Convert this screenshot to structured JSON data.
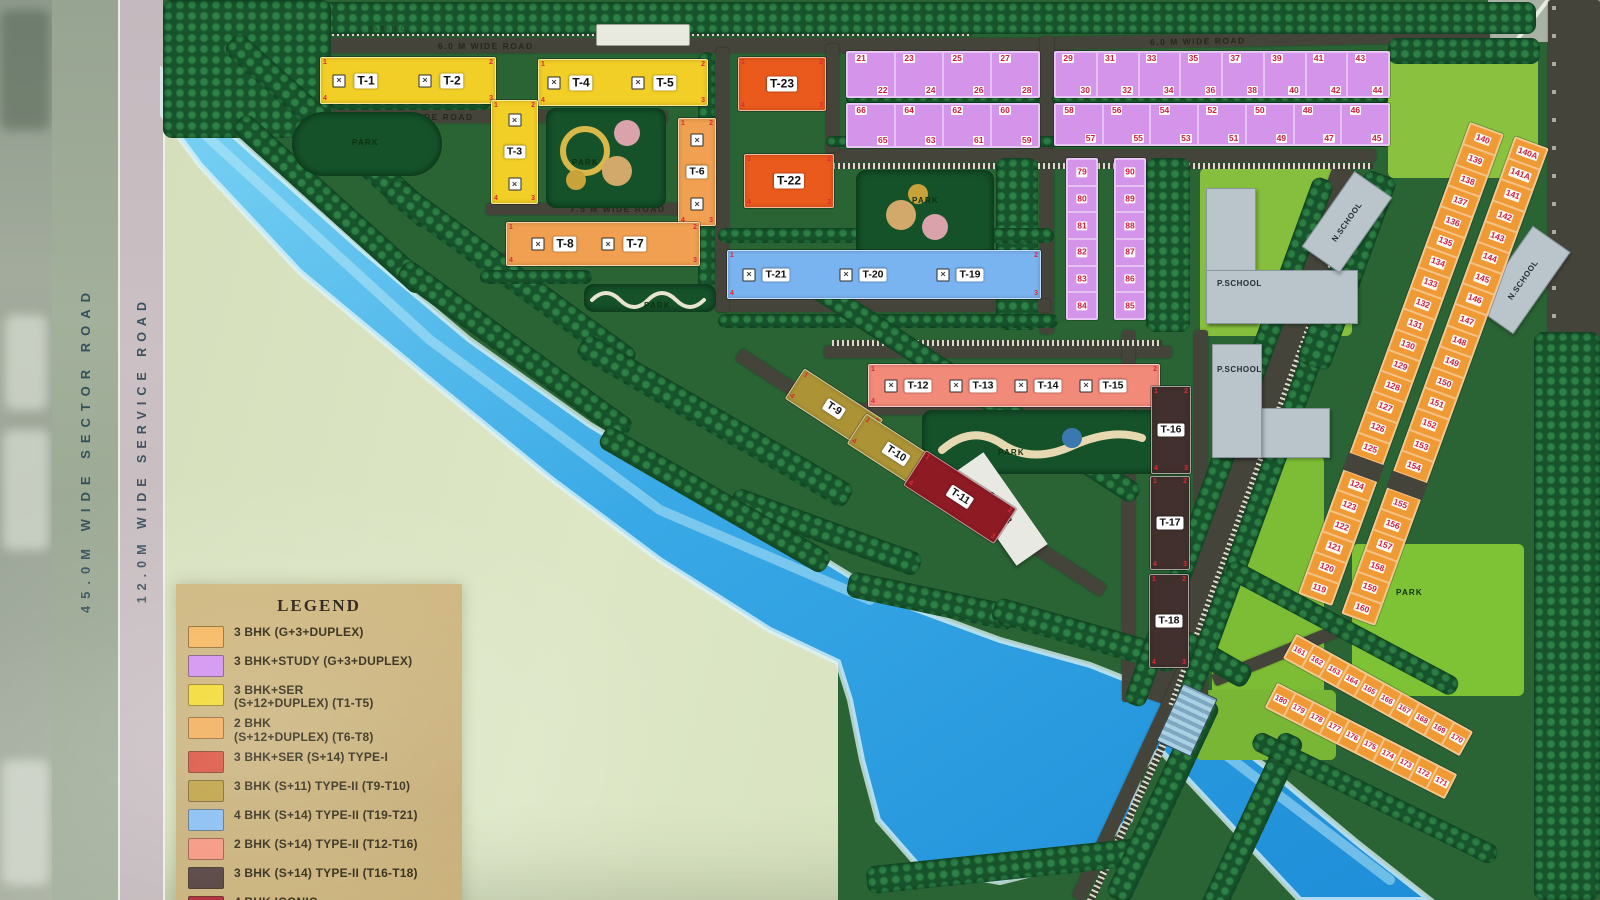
{
  "side_roads": {
    "sector": "45.0M WIDE SECTOR ROAD",
    "service": "12.0M WIDE SERVICE ROAD"
  },
  "roads": {
    "road-top": "6.0 M WIDE ROAD",
    "road-topright": "6.0 M WIDE ROAD",
    "road-75a": "7.5 M WIDE ROAD",
    "road-75b": "7.5 M WIDE ROAD",
    "road-75c": "7.5 M WIDE ROAD"
  },
  "facilities": {
    "parking": "PARKING",
    "park": "PARK",
    "p_school": "P.SCHOOL",
    "n_school": "N.SCHOOL",
    "club": "CLUB"
  },
  "towers": {
    "t1": "T-1",
    "t2": "T-2",
    "t3": "T-3",
    "t4": "T-4",
    "t5": "T-5",
    "t6": "T-6",
    "t7": "T-7",
    "t8": "T-8",
    "t9": "T-9",
    "t10": "T-10",
    "t11": "T-11",
    "t12": "T-12",
    "t13": "T-13",
    "t14": "T-14",
    "t15": "T-15",
    "t16": "T-16",
    "t17": "T-17",
    "t18": "T-18",
    "t19": "T-19",
    "t20": "T-20",
    "t21": "T-21",
    "t22": "T-22",
    "t23": "T-23"
  },
  "corner_digits": [
    "1",
    "2",
    "3",
    "4"
  ],
  "icons": {
    "unit_marker": "✕"
  },
  "plot_blocks": {
    "pa1": {
      "upper": [
        "21",
        "23",
        "25",
        "27"
      ],
      "lower": [
        "22",
        "24",
        "26",
        "28"
      ]
    },
    "pa2": {
      "upper": [
        "66",
        "64",
        "62",
        "60"
      ],
      "lower": [
        "65",
        "63",
        "61",
        "59"
      ]
    },
    "pb1": {
      "upper": [
        "29",
        "31",
        "33",
        "35",
        "37",
        "39",
        "41",
        "43"
      ],
      "lower": [
        "30",
        "32",
        "34",
        "36",
        "38",
        "40",
        "42",
        "44"
      ]
    },
    "pb2": {
      "upper": [
        "58",
        "56",
        "54",
        "52",
        "50",
        "48",
        "46"
      ],
      "lower": [
        "57",
        "55",
        "53",
        "51",
        "49",
        "47",
        "45"
      ]
    },
    "pv1": {
      "numbers": [
        "79",
        "80",
        "81",
        "82",
        "83",
        "84"
      ]
    },
    "pv2": {
      "numbers": [
        "90",
        "89",
        "88",
        "87",
        "86",
        "85"
      ]
    },
    "os_inner": {
      "numbers": [
        "140",
        "139",
        "138",
        "137",
        "136",
        "135",
        "134",
        "133",
        "132",
        "131",
        "130",
        "129",
        "128",
        "127",
        "126",
        "125"
      ],
      "numbers2": [
        "124",
        "123",
        "122",
        "121",
        "120",
        "119"
      ]
    },
    "os_outer": {
      "numbers": [
        "140A",
        "141A",
        "141",
        "142",
        "143",
        "144",
        "145",
        "146",
        "147",
        "148",
        "149",
        "150",
        "151",
        "152",
        "153",
        "154"
      ],
      "numbers2": [
        "155",
        "156",
        "157",
        "158",
        "159",
        "160"
      ]
    },
    "ob_row1": {
      "numbers": [
        "161",
        "162",
        "163",
        "164",
        "165",
        "166",
        "167",
        "168",
        "169",
        "170"
      ]
    },
    "ob_row2": {
      "numbers": [
        "180",
        "179",
        "178",
        "177",
        "176",
        "175",
        "174",
        "173",
        "172",
        "171"
      ]
    }
  },
  "legend": {
    "title": "LEGEND",
    "items": [
      {
        "color": "#f6b45a",
        "text": "3 BHK (G+3+DUPLEX)"
      },
      {
        "color": "#cf8cf0",
        "text": "3 BHK+STUDY (G+3+DUPLEX)"
      },
      {
        "color": "#f2d825",
        "text": "3 BHK+SER\n(S+12+DUPLEX) (T1-T5)"
      },
      {
        "color": "#f2a84e",
        "text": "2 BHK\n(S+12+DUPLEX) (T6-T8)"
      },
      {
        "color": "#d84330",
        "text": "3 BHK+SER (S+14) TYPE-I"
      },
      {
        "color": "#b99a35",
        "text": "3 BHK (S+11) TYPE-II (T9-T10)"
      },
      {
        "color": "#7fb9f2",
        "text": "4 BHK (S+14) TYPE-II (T19-T21)"
      },
      {
        "color": "#f58f78",
        "text": "2 BHK (S+14) TYPE-II (T12-T16)"
      },
      {
        "color": "#4a3635",
        "text": "3 BHK (S+14) TYPE-II (T16-T18)"
      },
      {
        "color": "#a81f2e",
        "text": "4 BHK ICONIC\n(S+10+DUPLEX) (T11)"
      }
    ]
  }
}
